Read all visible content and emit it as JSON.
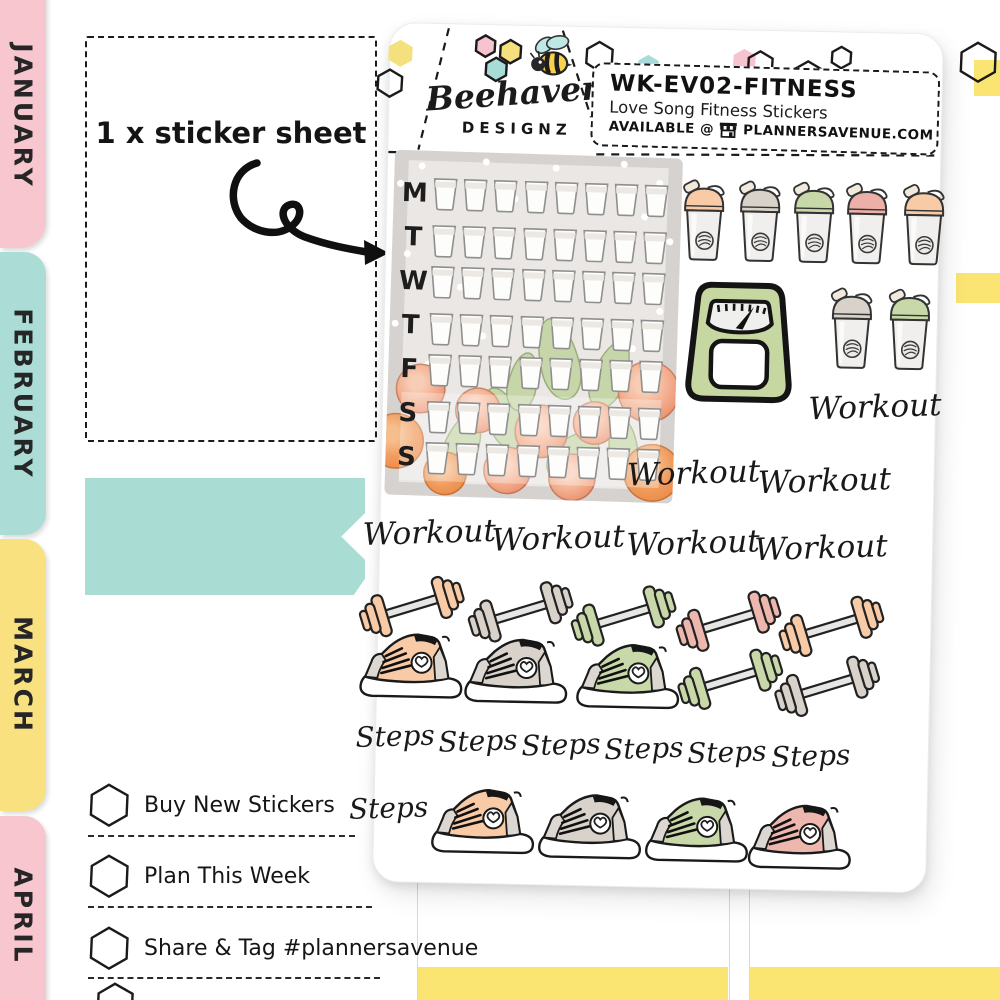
{
  "brand": {
    "script_name": "Beehaven",
    "caps_name": "DESIGNZ"
  },
  "product_label": {
    "sku": "WK-EV02-FITNESS",
    "title": "Love Song Fitness Stickers",
    "availability_prefix": "AVAILABLE @",
    "store": "PLANNERSAVENUE.COM"
  },
  "left_panel": {
    "sheet_note": "1 x sticker sheet",
    "month_tabs": [
      {
        "label": "JANUARY",
        "color": "#f7c6ce"
      },
      {
        "label": "FEBRUARY",
        "color": "#abddd6"
      },
      {
        "label": "MARCH",
        "color": "#f8e17e"
      },
      {
        "label": "APRIL",
        "color": "#f7c6ce"
      }
    ],
    "checklist": [
      "Buy New Stickers",
      "Plan This Week",
      "Share & Tag #plannersavenue"
    ]
  },
  "sheet": {
    "water_tracker": {
      "day_labels": [
        "M",
        "T",
        "W",
        "T",
        "F",
        "S",
        "S"
      ],
      "cups_per_day": 8
    },
    "labels": {
      "workout": "Workout",
      "steps": "Steps"
    },
    "workout_sticker_count": 7,
    "steps_sticker_count": 7,
    "shaker_bottles": {
      "row1_lid_colors": [
        "#f8cba6",
        "#d9d2ca",
        "#c8d8a8",
        "#ecb0a8",
        "#f8cba6"
      ],
      "row2_lid_colors": [
        "#d9d2ca",
        "#c8d8a8"
      ]
    },
    "dumbbell_colors": [
      "#f8cba6",
      "#d9d2ca",
      "#c8d8a8",
      "#eeb7ae",
      "#f8cba6",
      "#c8d8a8",
      "#d9d2ca"
    ],
    "sneaker_colors": {
      "row1": [
        "#f8cba6",
        "#d9d2ca",
        "#c8d8a8"
      ],
      "row2": [
        "#f8cba6",
        "#d9d2ca",
        "#c8d8a8",
        "#eeb7ae"
      ]
    },
    "scale_color": "#c6d7a2"
  },
  "colors": {
    "banner_teal": "#a9dcd3",
    "washi_yellow": "#fae472",
    "tracker_bg": "#d6d2cf",
    "tracker_panel": "#eae7e4",
    "logo_hex_pink": "#f6c3cf",
    "logo_hex_yellow": "#f5e07e",
    "logo_hex_teal": "#a8dcd9"
  }
}
